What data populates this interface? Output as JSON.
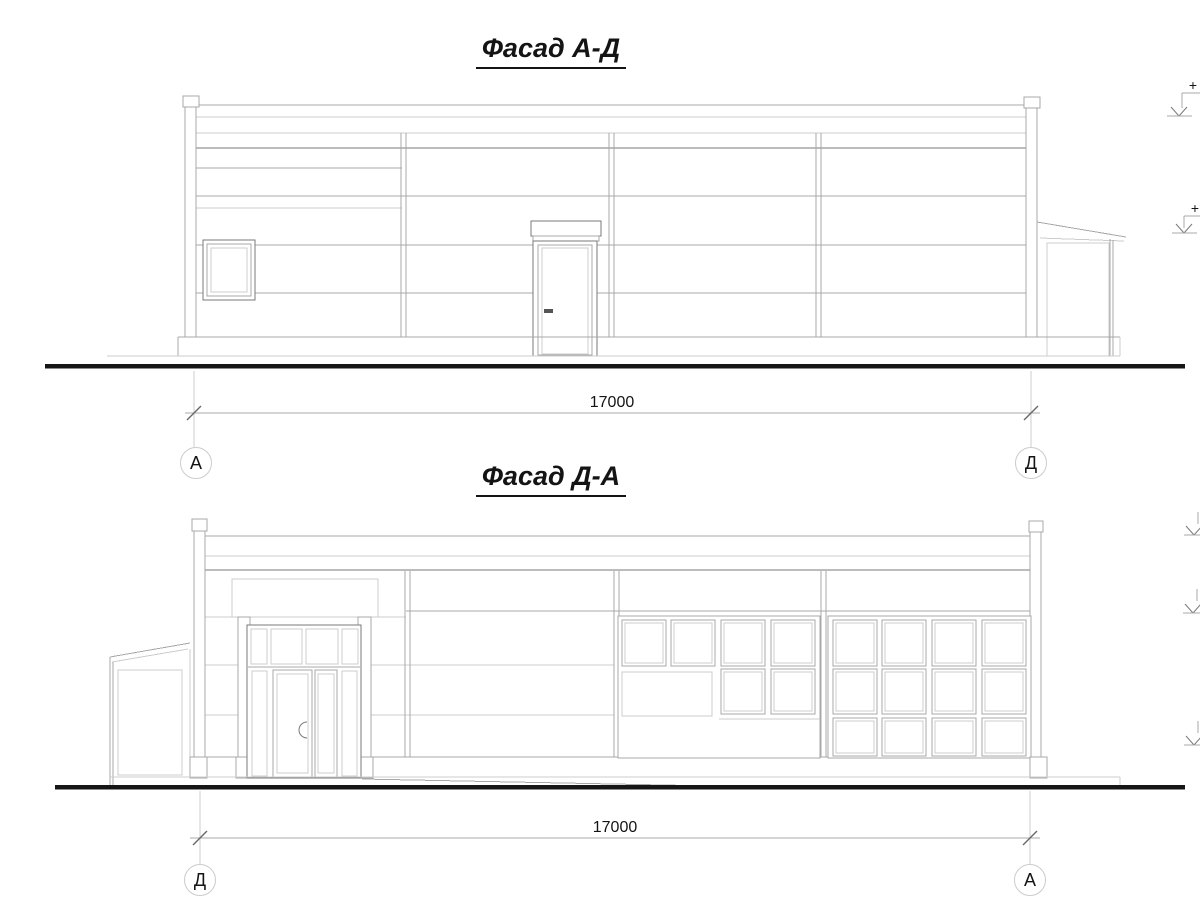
{
  "facade_1": {
    "title": "Фасад А-Д",
    "dimension_label": "17000",
    "axis_left": "А",
    "axis_right": "Д",
    "elevation_plus_top": "+",
    "elevation_plus_mid": "+"
  },
  "facade_2": {
    "title": "Фасад Д-А",
    "dimension_label": "17000",
    "axis_left": "Д",
    "axis_right": "А"
  },
  "colors": {
    "bg": "#ffffff",
    "line_light": "#cccccc",
    "line_mid": "#a8a8a8",
    "line_dark": "#7a7a7a",
    "ground": "#161616"
  }
}
